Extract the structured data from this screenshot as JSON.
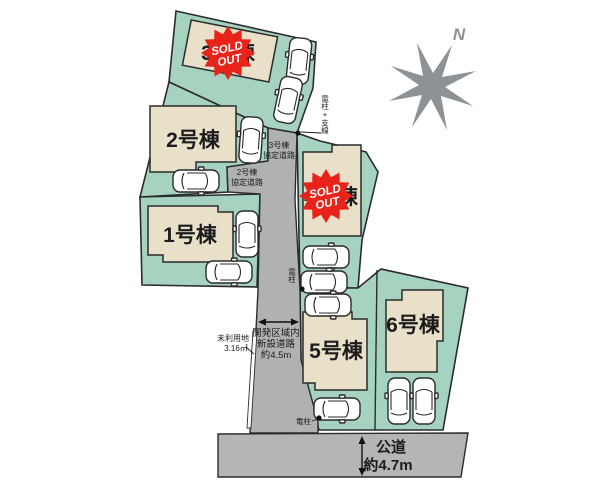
{
  "site_plan": {
    "compass": {
      "north_label": "N"
    },
    "sold_out_badge": {
      "line1": "SOLD",
      "line2": "OUT"
    },
    "parcels": [
      {
        "label": "1号棟",
        "sold_out": false
      },
      {
        "label": "2号棟",
        "sold_out": false
      },
      {
        "label": "3号棟",
        "sold_out": true
      },
      {
        "label": "4号棟",
        "sold_out": true
      },
      {
        "label": "5号棟",
        "sold_out": false
      },
      {
        "label": "6号棟",
        "sold_out": false
      }
    ],
    "roads": {
      "agreement_road_3": {
        "line1": "3号棟",
        "line2": "協定道路"
      },
      "agreement_road_2": {
        "line1": "2号棟",
        "line2": "協定道路"
      },
      "new_road": {
        "line1": "開発区域内",
        "line2": "新設道路",
        "line3": "約4.5m"
      },
      "public_road": {
        "line1": "公道",
        "line2": "約4.7m"
      }
    },
    "annotations": {
      "unused_land": {
        "line1": "未利用地",
        "line2": "3.16㎡"
      },
      "pole_with_guy_label": "電柱+支線",
      "pole_mid_label": "電柱",
      "pole_bottom_label": "電柱"
    },
    "colors": {
      "parcel_green": "#a6d3bf",
      "building_beige": "#e9e0ca",
      "road_gray": "#b0b1b3",
      "public_road_gray": "#b4b5b6",
      "sold_out_red": "#e8231a",
      "compass_gray": "#8d9296",
      "outline": "#2b2b2b"
    }
  }
}
